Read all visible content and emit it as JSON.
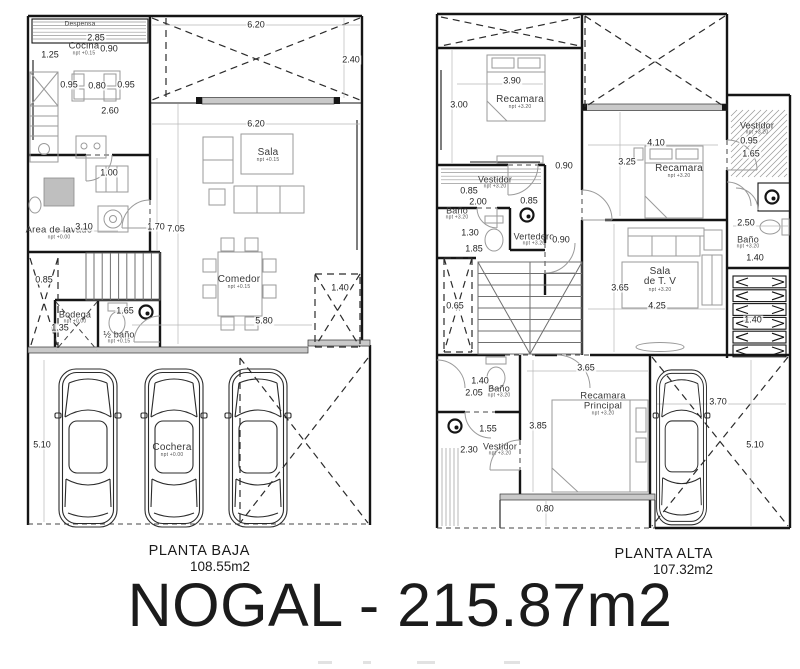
{
  "title": "NOGAL - 215.87m2",
  "plans": [
    {
      "id": "baja",
      "label": "PLANTA BAJA",
      "area": "108.55m2",
      "rooms": [
        {
          "name": "Despensa",
          "npt": "",
          "x": 80,
          "y": 25,
          "fs": 6.5
        },
        {
          "name": "Cocina",
          "npt": "npt +0.15",
          "x": 84,
          "y": 49,
          "fs": 9.5
        },
        {
          "name": "Sala",
          "npt": "npt +0.15",
          "x": 268,
          "y": 156,
          "fs": 10
        },
        {
          "name": "Comedor",
          "npt": "npt +0.15",
          "x": 239,
          "y": 283,
          "fs": 10
        },
        {
          "name": "Area de lavado",
          "npt": "npt +0.00",
          "x": 59,
          "y": 233,
          "fs": 9.5
        },
        {
          "name": "Bodega",
          "npt": "npt +0.00",
          "x": 75,
          "y": 318,
          "fs": 9
        },
        {
          "name": "½ baño",
          "npt": "npt +0.15",
          "x": 119,
          "y": 338,
          "fs": 9
        },
        {
          "name": "Cochera",
          "npt": "npt +0.00",
          "x": 172,
          "y": 451,
          "fs": 10
        }
      ],
      "dims": [
        {
          "v": "2.85",
          "x": 96,
          "y": 38
        },
        {
          "v": "0.90",
          "x": 109,
          "y": 49
        },
        {
          "v": "1.25",
          "x": 50,
          "y": 55
        },
        {
          "v": "0.95",
          "x": 69,
          "y": 85
        },
        {
          "v": "0.80",
          "x": 97,
          "y": 86
        },
        {
          "v": "0.95",
          "x": 126,
          "y": 85
        },
        {
          "v": "2.60",
          "x": 110,
          "y": 111
        },
        {
          "v": "6.20",
          "x": 256,
          "y": 25
        },
        {
          "v": "2.40",
          "x": 351,
          "y": 60
        },
        {
          "v": "6.20",
          "x": 256,
          "y": 124
        },
        {
          "v": "1.00",
          "x": 109,
          "y": 173
        },
        {
          "v": "3.10",
          "x": 84,
          "y": 227
        },
        {
          "v": "1.70",
          "x": 156,
          "y": 227
        },
        {
          "v": "7.05",
          "x": 176,
          "y": 229
        },
        {
          "v": "0.85",
          "x": 44,
          "y": 280
        },
        {
          "v": "1.35",
          "x": 60,
          "y": 328
        },
        {
          "v": "1.65",
          "x": 125,
          "y": 311
        },
        {
          "v": "5.80",
          "x": 264,
          "y": 321
        },
        {
          "v": "1.40",
          "x": 340,
          "y": 288
        },
        {
          "v": "5.10",
          "x": 42,
          "y": 445
        }
      ]
    },
    {
      "id": "alta",
      "label": "PLANTA ALTA",
      "area": "107.32m2",
      "rooms": [
        {
          "name": "Recamara",
          "npt": "npt +3.20",
          "x": 520,
          "y": 103,
          "fs": 10
        },
        {
          "name": "Vestidor",
          "npt": "npt +3.20",
          "x": 757,
          "y": 129,
          "fs": 9
        },
        {
          "name": "Recamara",
          "npt": "npt +3.20",
          "x": 679,
          "y": 172,
          "fs": 10
        },
        {
          "name": "Vestidor",
          "npt": "npt +3.20",
          "x": 495,
          "y": 183,
          "fs": 9
        },
        {
          "name": "Baño",
          "npt": "npt +3.20",
          "x": 457,
          "y": 214,
          "fs": 9
        },
        {
          "name": "Vertedero",
          "npt": "npt +3.20",
          "x": 534,
          "y": 240,
          "fs": 9
        },
        {
          "name": "Baño",
          "npt": "npt +3.20",
          "x": 748,
          "y": 243,
          "fs": 9
        },
        {
          "name": "Sala",
          "name2": "de T. V",
          "npt": "npt +3.20",
          "x": 660,
          "y": 280,
          "fs": 10
        },
        {
          "name": "Recamara",
          "name2": "Principal",
          "npt": "npt +3.20",
          "x": 603,
          "y": 404,
          "fs": 9.5
        },
        {
          "name": "Baño",
          "npt": "npt +3.20",
          "x": 499,
          "y": 392,
          "fs": 9
        },
        {
          "name": "Vestidor",
          "npt": "npt +3.20",
          "x": 500,
          "y": 450,
          "fs": 9
        }
      ],
      "dims": [
        {
          "v": "3.00",
          "x": 459,
          "y": 105
        },
        {
          "v": "3.90",
          "x": 512,
          "y": 81
        },
        {
          "v": "0.90",
          "x": 564,
          "y": 166
        },
        {
          "v": "4.10",
          "x": 656,
          "y": 143
        },
        {
          "v": "3.25",
          "x": 627,
          "y": 162
        },
        {
          "v": "0.95",
          "x": 749,
          "y": 141
        },
        {
          "v": "1.65",
          "x": 751,
          "y": 154
        },
        {
          "v": "0.85",
          "x": 469,
          "y": 191
        },
        {
          "v": "2.00",
          "x": 478,
          "y": 202
        },
        {
          "v": "0.85",
          "x": 529,
          "y": 201
        },
        {
          "v": "1.30",
          "x": 470,
          "y": 233
        },
        {
          "v": "1.85",
          "x": 474,
          "y": 249
        },
        {
          "v": "0.90",
          "x": 561,
          "y": 240
        },
        {
          "v": "2.50",
          "x": 746,
          "y": 223
        },
        {
          "v": "1.40",
          "x": 755,
          "y": 258
        },
        {
          "v": "3.65",
          "x": 620,
          "y": 288
        },
        {
          "v": "4.25",
          "x": 657,
          "y": 306
        },
        {
          "v": "1.40",
          "x": 753,
          "y": 320
        },
        {
          "v": "0.65",
          "x": 455,
          "y": 306
        },
        {
          "v": "1.40",
          "x": 480,
          "y": 381
        },
        {
          "v": "2.05",
          "x": 474,
          "y": 393
        },
        {
          "v": "1.55",
          "x": 488,
          "y": 429
        },
        {
          "v": "2.30",
          "x": 469,
          "y": 450
        },
        {
          "v": "3.85",
          "x": 538,
          "y": 426
        },
        {
          "v": "3.65",
          "x": 586,
          "y": 368
        },
        {
          "v": "3.70",
          "x": 718,
          "y": 402
        },
        {
          "v": "5.10",
          "x": 755,
          "y": 445
        },
        {
          "v": "0.80",
          "x": 545,
          "y": 509
        }
      ]
    }
  ]
}
